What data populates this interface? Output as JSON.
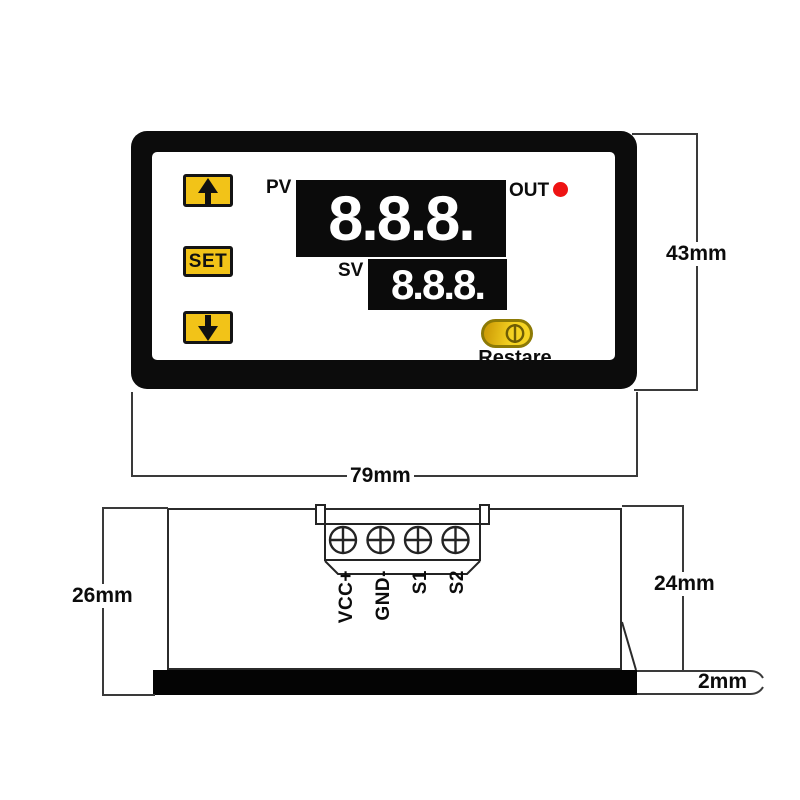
{
  "front_view": {
    "pv_label": "PV",
    "pv_value": "8.8.8.",
    "sv_label": "SV",
    "sv_value": "8.8.8.",
    "out_label": "OUT",
    "set_button": "SET",
    "restart_button": "Restare"
  },
  "rear_view": {
    "terminal_labels": [
      "VCC+",
      "GND-",
      "S1",
      "S2"
    ]
  },
  "dimensions": {
    "front_height": "43mm",
    "front_width": "79mm",
    "body_depth": "26mm",
    "rear_depth": "24mm",
    "panel_thickness": "2mm"
  },
  "colors": {
    "button_yellow": "#f2c318",
    "restart_yellow": "#f5d322",
    "restart_border_olive": "#8d7a06",
    "bezel_black": "#0c0c0c",
    "display_black": "#0b0b0b",
    "display_text_white": "#ffffff",
    "led_red": "#ee1313",
    "drawing_line_gray": "#3a3a3a"
  },
  "icons": {
    "up_button": "arrow-up-icon",
    "down_button": "arrow-down-icon",
    "restart_button": "power-toggle-icon",
    "terminal_screws": "cross-screw-head-icon",
    "out_indicator": "red-led-dot"
  }
}
